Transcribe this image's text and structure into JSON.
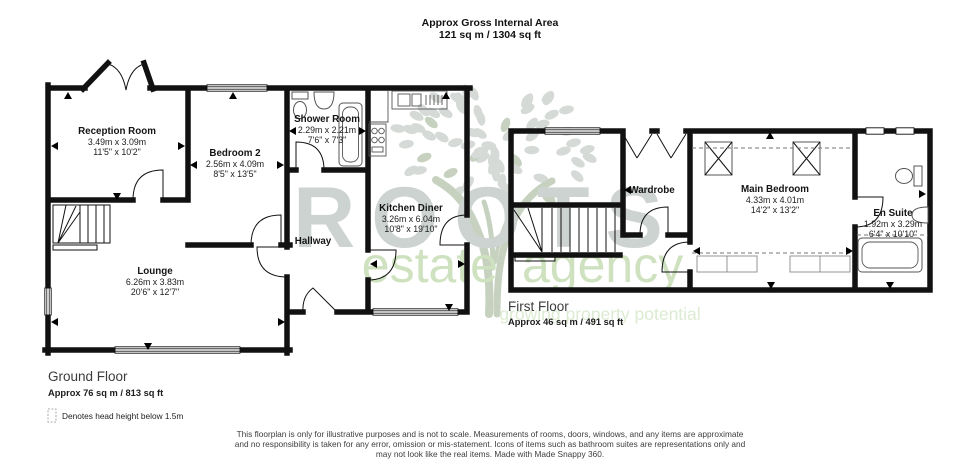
{
  "header": {
    "title": "Approx Gross Internal Area",
    "area": "121 sq m / 1304 sq ft"
  },
  "watermark": {
    "brand": "ROOTS",
    "subtitle_left": "estate",
    "subtitle_right": "agency",
    "tagline": "growing property potential"
  },
  "ground_floor": {
    "title": "Ground Floor",
    "area_label": "Approx 76 sq m / 813 sq ft",
    "rooms": {
      "reception": {
        "name": "Reception Room",
        "metric": "3.49m x 3.09m",
        "imperial": "11'5\" x 10'2\""
      },
      "bedroom2": {
        "name": "Bedroom 2",
        "metric": "2.56m x 4.09m",
        "imperial": "8'5\" x 13'5\""
      },
      "shower": {
        "name": "Shower Room",
        "metric": "2.29m x 2.21m",
        "imperial": "7'6\" x 7'3\""
      },
      "kitchen": {
        "name": "Kitchen Diner",
        "metric": "3.26m x 6.04m",
        "imperial": "10'8\" x 19'10\""
      },
      "hallway": {
        "name": "Hallway"
      },
      "lounge": {
        "name": "Lounge",
        "metric": "6.26m x 3.83m",
        "imperial": "20'6\" x 12'7\""
      }
    }
  },
  "first_floor": {
    "title": "First Floor",
    "area_label": "Approx 46 sq m / 491 sq ft",
    "rooms": {
      "wardrobe": {
        "name": "Wardrobe"
      },
      "main_bedroom": {
        "name": "Main Bedroom",
        "metric": "4.33m x 4.01m",
        "imperial": "14'2\" x 13'2\""
      },
      "ensuite": {
        "name": "En Suite",
        "metric": "1.92m x 3.29m",
        "imperial": "6'4\" x 10'10\""
      }
    }
  },
  "legend": {
    "head_height": "Denotes head height below 1.5m"
  },
  "footer": {
    "line1": "This floorplan is only for illustrative purposes and is not to scale. Measurements of rooms, doors, windows, and any items are approximate",
    "line2": "and no responsibility is taken for any error, omission or mis-statement. Icons of items such as bathroom suites are representations only and",
    "line3": "may not look like the real items. Made with Made Snappy 360."
  },
  "colors": {
    "wall": "#111111",
    "watermark_leaf": "#d5dad7",
    "watermark_trunk": "#c6d2bf",
    "watermark_brand": "#cdd3d0",
    "watermark_green": "#cfe2c0",
    "watermark_tagline": "#dcebd2"
  }
}
